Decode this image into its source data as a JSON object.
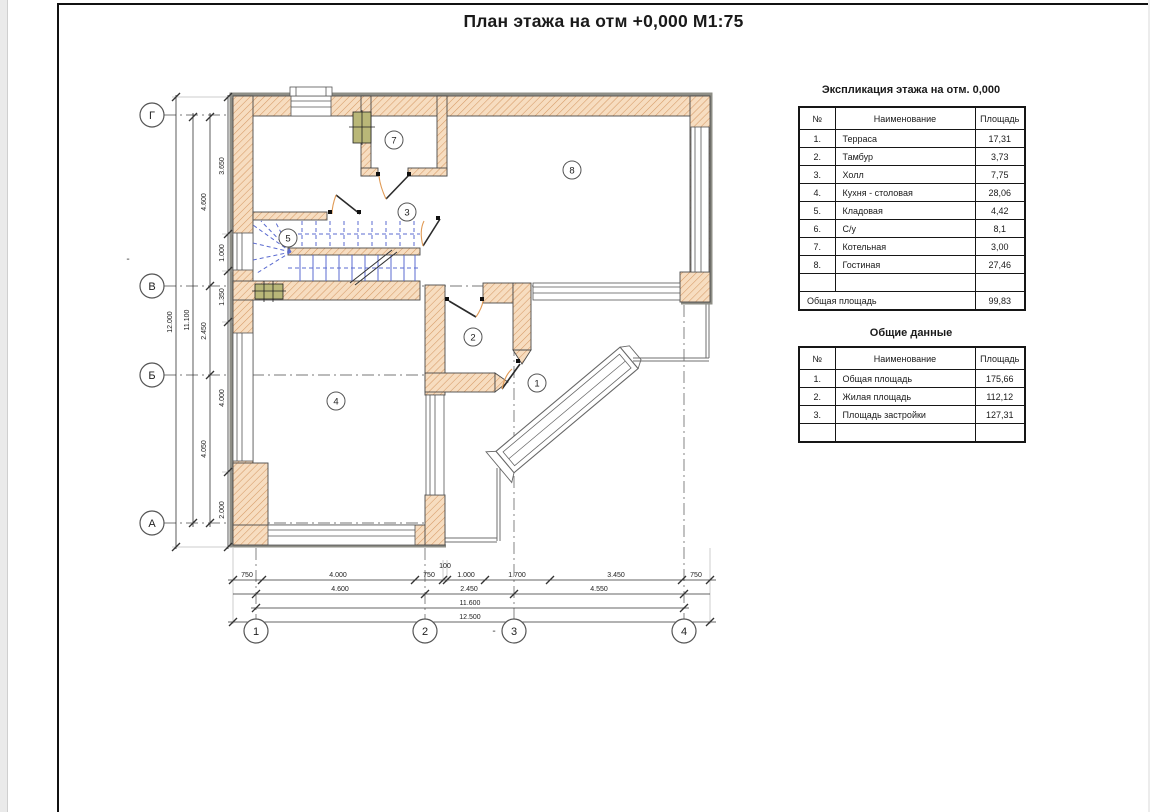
{
  "sheet": {
    "title": "План этажа на отм +0,000 М1:75"
  },
  "plan": {
    "axes_left": [
      "Г",
      "В",
      "Б",
      "А"
    ],
    "axes_bottom": [
      "1",
      "2",
      "3",
      "4"
    ],
    "rooms": [
      "1",
      "2",
      "3",
      "4",
      "5",
      "7",
      "8"
    ],
    "dims_left_inner": [
      "3.650",
      "1.000",
      "1.350",
      "4.000",
      "2.000"
    ],
    "dims_left_axes": [
      "4.600",
      "2.450",
      "4.050"
    ],
    "dims_left_total_axes": "11.100",
    "dims_left_total": "12.000",
    "dims_bottom_row1": [
      "750",
      "4.000",
      "750",
      "1.000",
      "1.700",
      "3.450",
      "750"
    ],
    "dim_100": "100",
    "dims_bottom_row2": [
      "4.600",
      "2.450",
      "4.550"
    ],
    "dims_bottom_row3": "11.600",
    "dims_bottom_row4": "12.500",
    "stray_mark1": "-",
    "stray_mark2": "-"
  },
  "explication": {
    "title": "Экспликация этажа на отм. 0,000",
    "headers": [
      "№",
      "Наименование",
      "Площадь"
    ],
    "rows": [
      [
        "1.",
        "Терраса",
        "17,31"
      ],
      [
        "2.",
        "Тамбур",
        "3,73"
      ],
      [
        "3.",
        "Холл",
        "7,75"
      ],
      [
        "4.",
        "Кухня - столовая",
        "28,06"
      ],
      [
        "5.",
        "Кладовая",
        "4,42"
      ],
      [
        "6.",
        "С/у",
        "8,1"
      ],
      [
        "7.",
        "Котельная",
        "3,00"
      ],
      [
        "8.",
        "Гостиная",
        "27,46"
      ],
      [
        "",
        "",
        ""
      ]
    ],
    "total_label": "Общая площадь",
    "total_value": "99,83"
  },
  "general": {
    "title": "Общие данные",
    "headers": [
      "№",
      "Наименование",
      "Площадь"
    ],
    "rows": [
      [
        "1.",
        "Общая площадь",
        "175,66"
      ],
      [
        "2.",
        "Жилая площадь",
        "112,12"
      ],
      [
        "3.",
        "Площадь застройки",
        "127,31"
      ],
      [
        "",
        "",
        ""
      ]
    ]
  },
  "colors": {
    "wall_fill": "#f7ddc0",
    "wall_hatch": "#d69a66",
    "wall_edge": "#4a4a4a",
    "outer_band": "#8e8e86",
    "stair_blue": "#5b6bd0",
    "door_orange": "#e09a55",
    "vent_green": "#b9b778",
    "axis_gray": "#777777"
  }
}
